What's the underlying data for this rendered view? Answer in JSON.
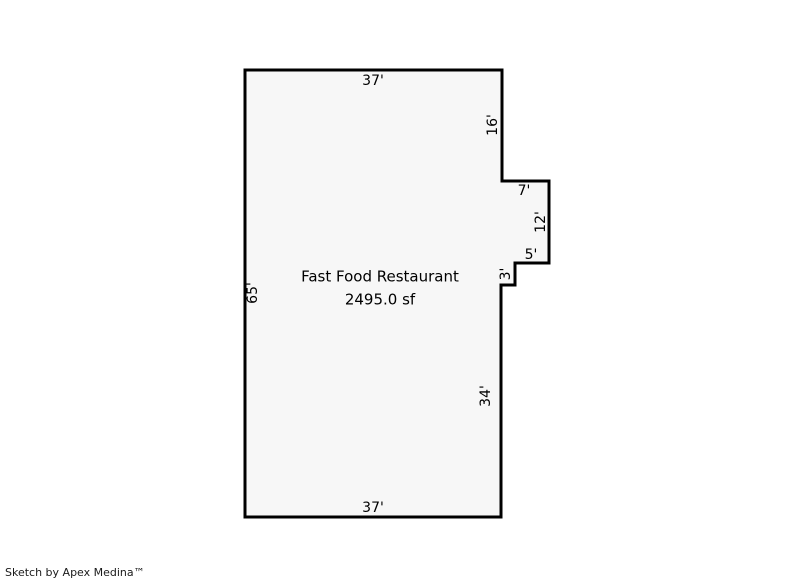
{
  "sketch": {
    "room_title": "Fast Food Restaurant",
    "room_area": "2495.0 sf",
    "dimensions": {
      "top": "37'",
      "right_upper": "16'",
      "jut_top": "7'",
      "jut_right": "12'",
      "notch_top": "5'",
      "notch_left": "3'",
      "right_lower": "34'",
      "bottom": "37'",
      "left": "65'"
    }
  },
  "footer": {
    "credit": "Sketch by Apex Medina™"
  },
  "colors": {
    "outline": "#000000",
    "room_fill": "#f7f7f7",
    "background": "#ffffff"
  }
}
